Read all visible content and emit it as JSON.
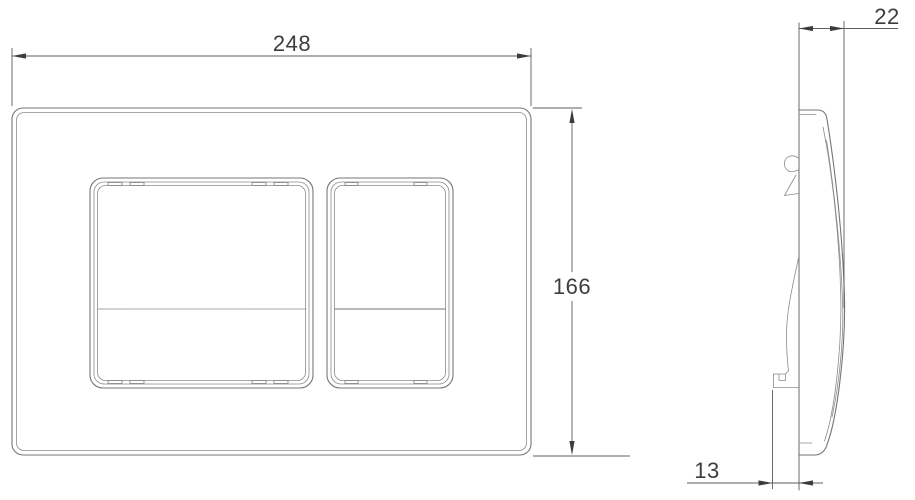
{
  "front_view": {
    "width_label": "248",
    "height_label": "166"
  },
  "side_view": {
    "depth_label": "22",
    "bracket_offset_label": "13"
  },
  "colors": {
    "background": "#ffffff",
    "outline_gray": "#767676",
    "dimension_gray": "#5c5c5c",
    "label_text": "#3d3d3d"
  }
}
